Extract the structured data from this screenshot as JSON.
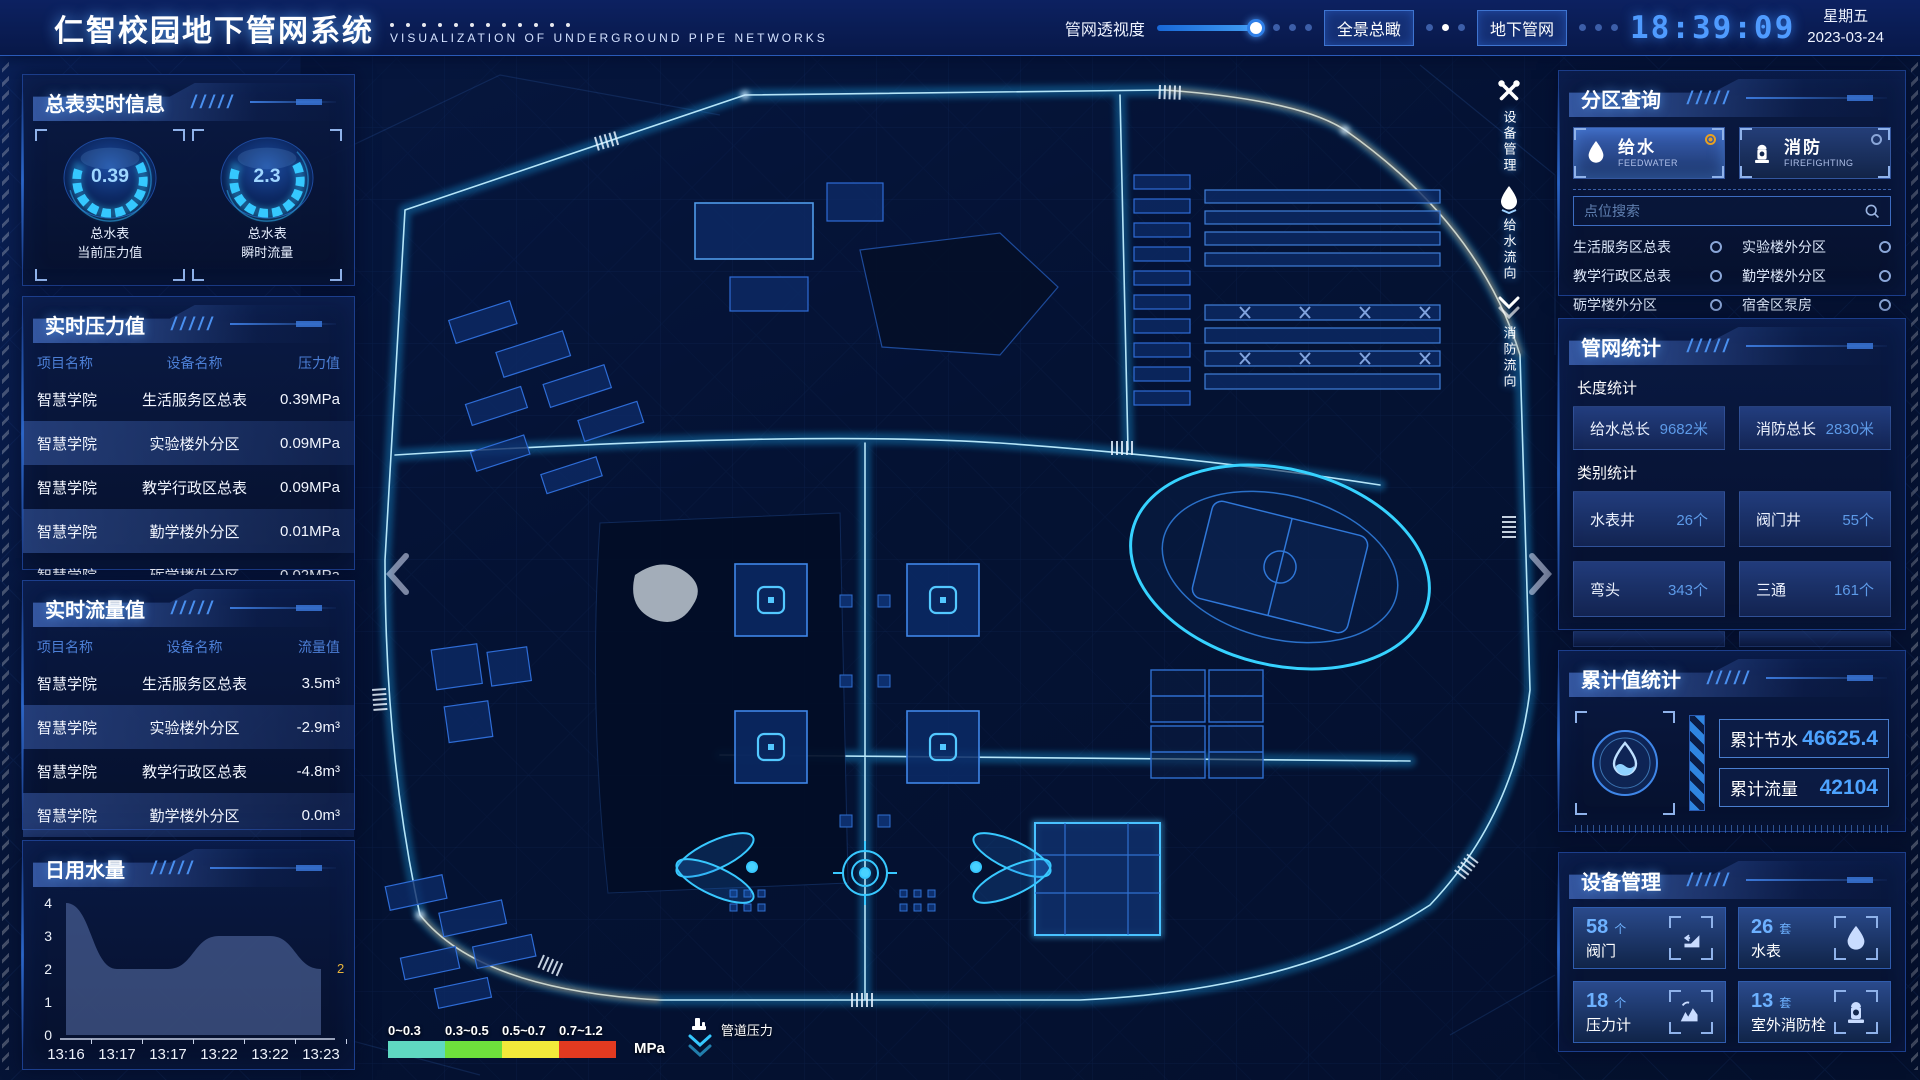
{
  "header": {
    "title": "仁智校园地下管网系统",
    "subtitle": "VISUALIZATION OF UNDERGROUND PIPE NETWORKS",
    "opacity_label": "管网透视度",
    "btn_overview": "全景总瞰",
    "btn_underground": "地下管网",
    "time": "18:39:09",
    "weekday": "星期五",
    "date": "2023-03-24"
  },
  "left": {
    "meter": {
      "title": "总表实时信息",
      "gauges": [
        {
          "value": "0.39",
          "line1": "总水表",
          "line2": "当前压力值"
        },
        {
          "value": "2.3",
          "line1": "总水表",
          "line2": "瞬时流量"
        }
      ]
    },
    "pressure": {
      "title": "实时压力值",
      "columns": [
        "项目名称",
        "设备名称",
        "压力值"
      ],
      "rows": [
        [
          "智慧学院",
          "生活服务区总表",
          "0.39MPa"
        ],
        [
          "智慧学院",
          "实验楼外分区",
          "0.09MPa"
        ],
        [
          "智慧学院",
          "教学行政区总表",
          "0.09MPa"
        ],
        [
          "智慧学院",
          "勤学楼外分区",
          "0.01MPa"
        ],
        [
          "智慧学院",
          "砺学楼外分区",
          "0.02MPa"
        ]
      ]
    },
    "flow": {
      "title": "实时流量值",
      "columns": [
        "项目名称",
        "设备名称",
        "流量值"
      ],
      "rows": [
        [
          "智慧学院",
          "生活服务区总表",
          "3.5m³"
        ],
        [
          "智慧学院",
          "实验楼外分区",
          "-2.9m³"
        ],
        [
          "智慧学院",
          "教学行政区总表",
          "-4.8m³"
        ],
        [
          "智慧学院",
          "勤学楼外分区",
          "0.0m³"
        ],
        [
          "智慧学院",
          "砺学楼外分区",
          "-2.3m³"
        ]
      ]
    },
    "daily": {
      "title": "日用水量"
    }
  },
  "chart_data": {
    "type": "area",
    "title": "日用水量",
    "x": [
      "13:16",
      "13:17",
      "13:17",
      "13:22",
      "13:22",
      "13:23"
    ],
    "values": [
      4,
      2,
      2,
      3,
      3,
      2
    ],
    "ylim": [
      0,
      4
    ],
    "y_ticks": [
      0,
      1,
      2,
      3,
      4
    ],
    "end_label": "2",
    "xlabel": "",
    "ylabel": "",
    "grid": false,
    "legend_position": "none"
  },
  "right": {
    "zone": {
      "title": "分区查询",
      "tabs": [
        {
          "label": "给水",
          "sub": "FEEDWATER",
          "selected": true
        },
        {
          "label": "消防",
          "sub": "FIREFIGHTING",
          "selected": false
        }
      ],
      "search_placeholder": "点位搜索",
      "items": [
        "生活服务区总表",
        "实验楼外分区",
        "教学行政区总表",
        "勤学楼外分区",
        "砺学楼外分区",
        "宿舍区泵房"
      ]
    },
    "stats": {
      "title": "管网统计",
      "length_label": "长度统计",
      "length": [
        {
          "label": "给水总长",
          "value": "9682米"
        },
        {
          "label": "消防总长",
          "value": "2830米"
        }
      ],
      "category_label": "类别统计",
      "category": [
        {
          "label": "水表井",
          "value": "26个"
        },
        {
          "label": "阀门井",
          "value": "55个"
        },
        {
          "label": "弯头",
          "value": "343个"
        },
        {
          "label": "三通",
          "value": "161个"
        }
      ]
    },
    "total": {
      "title": "累计值统计",
      "rows": [
        {
          "label": "累计节水",
          "value": "46625.4"
        },
        {
          "label": "累计流量",
          "value": "42104"
        }
      ]
    },
    "device": {
      "title": "设备管理",
      "cards": [
        {
          "count": "58",
          "unit": "个",
          "label": "阀门"
        },
        {
          "count": "26",
          "unit": "套",
          "label": "水表"
        },
        {
          "count": "18",
          "unit": "个",
          "label": "压力计"
        },
        {
          "count": "13",
          "unit": "套",
          "label": "室外消防栓"
        }
      ]
    }
  },
  "map": {
    "tools": [
      {
        "label": "设备管理"
      },
      {
        "label": "给水流向"
      },
      {
        "label": "消防流向"
      }
    ],
    "legend": {
      "ranges": [
        "0~0.3",
        "0.3~0.5",
        "0.5~0.7",
        "0.7~1.2"
      ],
      "colors": [
        "#5fd8c1",
        "#6ee03c",
        "#f2e93a",
        "#e23a20"
      ],
      "unit": "MPa",
      "pipe_label": "管道压力"
    },
    "accent": "#2fd9ff"
  }
}
